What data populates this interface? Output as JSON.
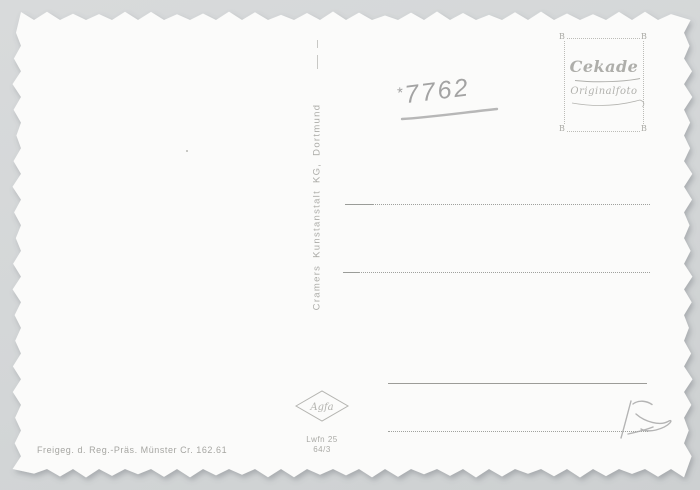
{
  "colors": {
    "background": "#d3d6d7",
    "card": "#fbfbfa",
    "print_gray": "#adada9",
    "line_gray": "#9c9e9a",
    "pencil_gray": "#a3a3a3"
  },
  "stamp_box": {
    "brand": "Cekade",
    "subtitle": "Originalfoto",
    "corner_marks": [
      "B",
      "B",
      "B",
      "B"
    ]
  },
  "handwritten": {
    "prefix": "*",
    "catalog_number": "7762",
    "pencil_scribble_reading": "15"
  },
  "publisher": {
    "vertical_text": "Cramers Kunstanstalt KG, Dortmund"
  },
  "printer": {
    "logo": "Agfa",
    "code_line1": "Lwfn 25",
    "code_line2": "64/3"
  },
  "approval_note": "Freigeg. d. Reg.-Präs. Münster Cr. 162.61"
}
